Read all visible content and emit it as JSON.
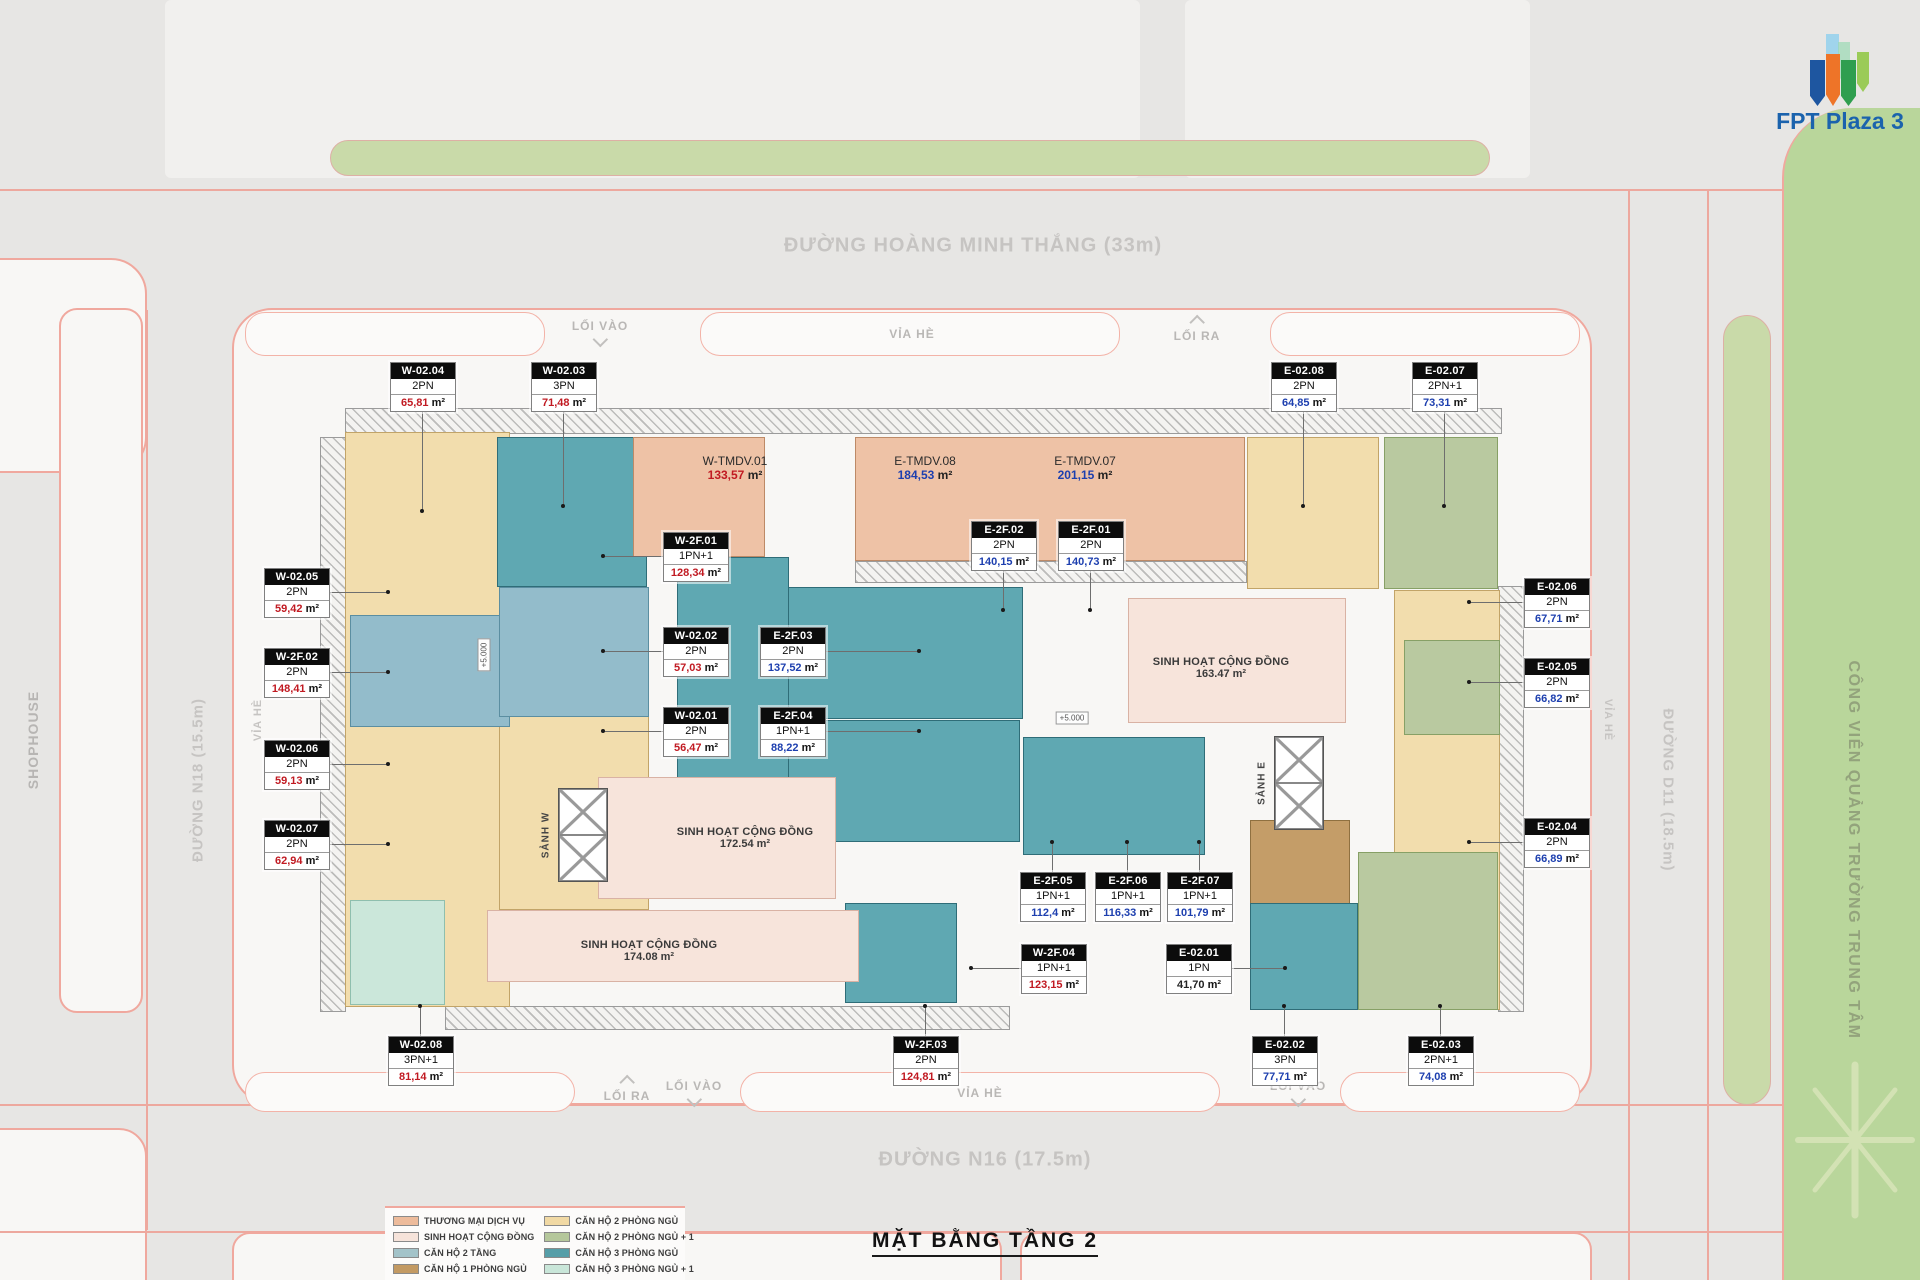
{
  "header": {
    "logo_text": "FPT Plaza 3",
    "title": "MẶT BẰNG TẦNG 2"
  },
  "roads": {
    "top": "ĐƯỜNG HOÀNG MINH THẮNG (33m)",
    "bottom": "ĐƯỜNG N16 (17.5m)",
    "left": "ĐƯỜNG N18 (15.5m)",
    "right": "ĐƯỜNG D11 (18.5m)",
    "shophouse": "SHOPHOUSE",
    "park": "CÔNG VIÊN QUẢNG TRƯỜNG TRUNG TÂM",
    "sidewalk": "VỈA HÈ",
    "entry": "LỐI VÀO",
    "exit": "LỐI RA"
  },
  "site": {
    "lobby_west": "SẢNH W",
    "lobby_east": "SẢNH E",
    "level_marker": "+5.000",
    "area_suffix": "m²"
  },
  "commercial_units": [
    {
      "code": "W-TMDV.01",
      "area": "133,57",
      "color": "#c11a22"
    },
    {
      "code": "E-TMDV.08",
      "area": "184,53",
      "color": "#1d3faf"
    },
    {
      "code": "E-TMDV.07",
      "area": "201,15",
      "color": "#1d3faf"
    }
  ],
  "community_areas": [
    {
      "name": "SINH HOẠT CỘNG ĐỒNG",
      "area": "163.47 m²"
    },
    {
      "name": "SINH HOẠT CỘNG ĐỒNG",
      "area": "172.54 m²"
    },
    {
      "name": "SINH HOẠT CỘNG ĐỒNG",
      "area": "174.08 m²"
    }
  ],
  "units": [
    {
      "code": "W-02.04",
      "type": "2PN",
      "area": "65,81",
      "color": "#c11a22"
    },
    {
      "code": "W-02.03",
      "type": "3PN",
      "area": "71,48",
      "color": "#c11a22"
    },
    {
      "code": "E-02.08",
      "type": "2PN",
      "area": "64,85",
      "color": "#1d3faf"
    },
    {
      "code": "E-02.07",
      "type": "2PN+1",
      "area": "73,31",
      "color": "#1d3faf"
    },
    {
      "code": "W-02.05",
      "type": "2PN",
      "area": "59,42",
      "color": "#c11a22"
    },
    {
      "code": "W-2F.02",
      "type": "2PN",
      "area": "148,41",
      "color": "#c11a22"
    },
    {
      "code": "W-02.06",
      "type": "2PN",
      "area": "59,13",
      "color": "#c11a22"
    },
    {
      "code": "W-02.07",
      "type": "2PN",
      "area": "62,94",
      "color": "#c11a22"
    },
    {
      "code": "W-2F.01",
      "type": "1PN+1",
      "area": "128,34",
      "color": "#c11a22"
    },
    {
      "code": "W-02.02",
      "type": "2PN",
      "area": "57,03",
      "color": "#c11a22"
    },
    {
      "code": "W-02.01",
      "type": "2PN",
      "area": "56,47",
      "color": "#c11a22"
    },
    {
      "code": "E-2F.02",
      "type": "2PN",
      "area": "140,15",
      "color": "#1d3faf"
    },
    {
      "code": "E-2F.01",
      "type": "2PN",
      "area": "140,73",
      "color": "#1d3faf"
    },
    {
      "code": "E-2F.03",
      "type": "2PN",
      "area": "137,52",
      "color": "#1d3faf"
    },
    {
      "code": "E-2F.04",
      "type": "1PN+1",
      "area": "88,22",
      "color": "#1d3faf"
    },
    {
      "code": "E-02.06",
      "type": "2PN",
      "area": "67,71",
      "color": "#1d3faf"
    },
    {
      "code": "E-02.05",
      "type": "2PN",
      "area": "66,82",
      "color": "#1d3faf"
    },
    {
      "code": "E-02.04",
      "type": "2PN",
      "area": "66,89",
      "color": "#1d3faf"
    },
    {
      "code": "E-2F.05",
      "type": "1PN+1",
      "area": "112,4",
      "color": "#1d3faf"
    },
    {
      "code": "E-2F.06",
      "type": "1PN+1",
      "area": "116,33",
      "color": "#1d3faf"
    },
    {
      "code": "E-2F.07",
      "type": "1PN+1",
      "area": "101,79",
      "color": "#1d3faf"
    },
    {
      "code": "W-2F.04",
      "type": "1PN+1",
      "area": "123,15",
      "color": "#c11a22"
    },
    {
      "code": "E-02.01",
      "type": "1PN",
      "area": "41,70",
      "color": "#222222"
    },
    {
      "code": "W-02.08",
      "type": "3PN+1",
      "area": "81,14",
      "color": "#c11a22"
    },
    {
      "code": "W-2F.03",
      "type": "2PN",
      "area": "124,81",
      "color": "#c11a22"
    },
    {
      "code": "E-02.02",
      "type": "3PN",
      "area": "77,71",
      "color": "#1d3faf"
    },
    {
      "code": "E-02.03",
      "type": "2PN+1",
      "area": "74,08",
      "color": "#1d3faf"
    }
  ],
  "legend": {
    "left": [
      {
        "label": "THƯƠNG MẠI DỊCH VỤ",
        "color": "#edbb9b"
      },
      {
        "label": "SINH HOẠT CỘNG ĐỒNG",
        "color": "#f6e3da"
      },
      {
        "label": "CĂN HỘ 2 TẦNG",
        "color": "#a3c3c9"
      },
      {
        "label": "CĂN HỘ 1 PHÒNG NGỦ",
        "color": "#c39a63"
      }
    ],
    "right": [
      {
        "label": "CĂN HỘ 2 PHÒNG NGỦ",
        "color": "#f1d9a4"
      },
      {
        "label": "CĂN HỘ 2 PHÒNG NGỦ + 1",
        "color": "#b5c79b"
      },
      {
        "label": "CĂN HỘ 3 PHÒNG NGỦ",
        "color": "#569ea8"
      },
      {
        "label": "CĂN HỘ 3 PHÒNG NGỦ + 1",
        "color": "#c9e6d9"
      }
    ]
  }
}
